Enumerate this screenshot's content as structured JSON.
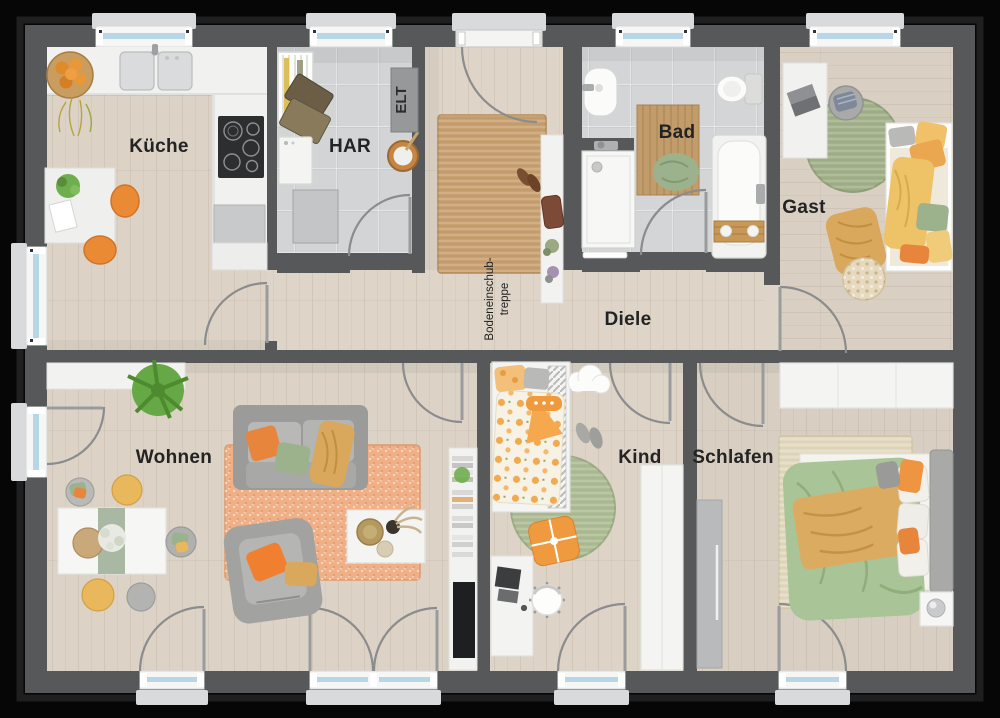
{
  "plan": {
    "type": "apartment-floor-plan",
    "rooms": {
      "kueche": {
        "label": "Küche"
      },
      "har": {
        "label": "HAR"
      },
      "bad": {
        "label": "Bad"
      },
      "gast": {
        "label": "Gast"
      },
      "diele": {
        "label": "Diele"
      },
      "wohnen": {
        "label": "Wohnen"
      },
      "kind": {
        "label": "Kind"
      },
      "schlafen": {
        "label": "Schlafen"
      }
    },
    "annotations": {
      "elt": {
        "label": "ELT"
      },
      "attic_stairs": {
        "line1": "Bodeneinschub-",
        "line2": "treppe"
      }
    },
    "colors": {
      "wall": "#57585a",
      "wood_floor": "#dbd2c5",
      "tile_floor": "#d3d5d6",
      "window_glass": "#b7d7e8",
      "accent_orange": "#ee8c3c",
      "accent_green": "#9cb28c",
      "accent_mustard": "#d9a85c",
      "rug_orange": "#f0b087",
      "rug_jute": "#c9a172"
    }
  }
}
